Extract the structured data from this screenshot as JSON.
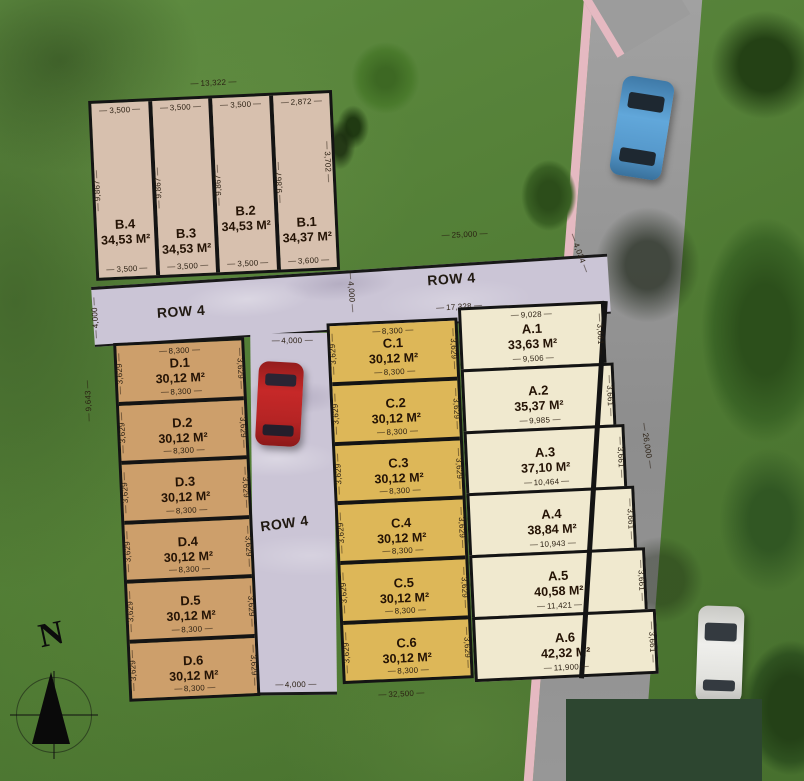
{
  "site": {
    "north_label": "N",
    "overall_dims": {
      "b_block_top": "13,322",
      "site_top_right": "25,000",
      "site_bottom": "32,500",
      "site_right": "26,000",
      "left_outer": "9,643"
    },
    "roads": {
      "row4_left_label": "ROW 4",
      "row4_right_label": "ROW 4",
      "row4_mid_label": "ROW 4",
      "dim_left_width": "4,000",
      "dim_band_mid_width": "4,000",
      "dim_mid_top_width": "4,000",
      "dim_mid_bottom_width": "4,000",
      "dim_right_width": "4,034",
      "dim_ca_length": "17,328"
    },
    "blocks": {
      "b": {
        "plots": [
          {
            "id": "B.4",
            "area": "34,53 M²",
            "top": "3,500",
            "bottom": "3,500",
            "side": "9,867"
          },
          {
            "id": "B.3",
            "area": "34,53 M²",
            "top": "3,500",
            "bottom": "3,500",
            "side": "9,867"
          },
          {
            "id": "B.2",
            "area": "34,53 M²",
            "top": "3,500",
            "bottom": "3,500",
            "side": "9,867"
          },
          {
            "id": "B.1",
            "area": "34,37 M²",
            "top": "2,872",
            "bottom": "3,600",
            "side": "9,867",
            "right": "3,702"
          }
        ]
      },
      "d": {
        "plots": [
          {
            "id": "D.1",
            "area": "30,12 M²",
            "width": "8,300",
            "side": "3,629"
          },
          {
            "id": "D.2",
            "area": "30,12 M²",
            "width": "8,300",
            "side": "3,629"
          },
          {
            "id": "D.3",
            "area": "30,12 M²",
            "width": "8,300",
            "side": "3,629"
          },
          {
            "id": "D.4",
            "area": "30,12 M²",
            "width": "8,300",
            "side": "3,629"
          },
          {
            "id": "D.5",
            "area": "30,12 M²",
            "width": "8,300",
            "side": "3,629"
          },
          {
            "id": "D.6",
            "area": "30,12 M²",
            "width": "8,300",
            "side": "3,629"
          }
        ]
      },
      "c": {
        "plots": [
          {
            "id": "C.1",
            "area": "30,12 M²",
            "width": "8,300",
            "side": "3,629"
          },
          {
            "id": "C.2",
            "area": "30,12 M²",
            "width": "8,300",
            "side": "3,629"
          },
          {
            "id": "C.3",
            "area": "30,12 M²",
            "width": "8,300",
            "side": "3,629"
          },
          {
            "id": "C.4",
            "area": "30,12 M²",
            "width": "8,300",
            "side": "3,629"
          },
          {
            "id": "C.5",
            "area": "30,12 M²",
            "width": "8,300",
            "side": "3,629"
          },
          {
            "id": "C.6",
            "area": "30,12 M²",
            "width": "8,300",
            "side": "3,629"
          }
        ]
      },
      "a": {
        "plots": [
          {
            "id": "A.1",
            "area": "33,63 M²",
            "top": "9,028",
            "bottom": "9,506",
            "side": "3,661"
          },
          {
            "id": "A.2",
            "area": "35,37 M²",
            "bottom": "9,985",
            "side": "3,661"
          },
          {
            "id": "A.3",
            "area": "37,10 M²",
            "bottom": "10,464",
            "side": "3,661"
          },
          {
            "id": "A.4",
            "area": "38,84 M²",
            "bottom": "10,943",
            "side": "3,661"
          },
          {
            "id": "A.5",
            "area": "40,58 M²",
            "bottom": "11,421",
            "side": "3,661"
          },
          {
            "id": "A.6",
            "area": "42,32 M²",
            "bottom": "11,900",
            "side": "3,661"
          }
        ]
      }
    },
    "colors": {
      "block_b": "#d7c0ae",
      "block_d": "#cd9f6b",
      "block_c": "#ddb758",
      "block_a": "#f0e9cf",
      "inner_road": "#cbc5d6",
      "outer_road": "#959595",
      "sidewalk": "#e5b9c1",
      "grass": "#55803a",
      "plot_border": "#141414"
    },
    "vehicles": [
      {
        "name": "red-car",
        "color": "#c22726"
      },
      {
        "name": "blue-car",
        "color": "#5b9fd0"
      },
      {
        "name": "white-car",
        "color": "#e9e9e6"
      }
    ]
  }
}
